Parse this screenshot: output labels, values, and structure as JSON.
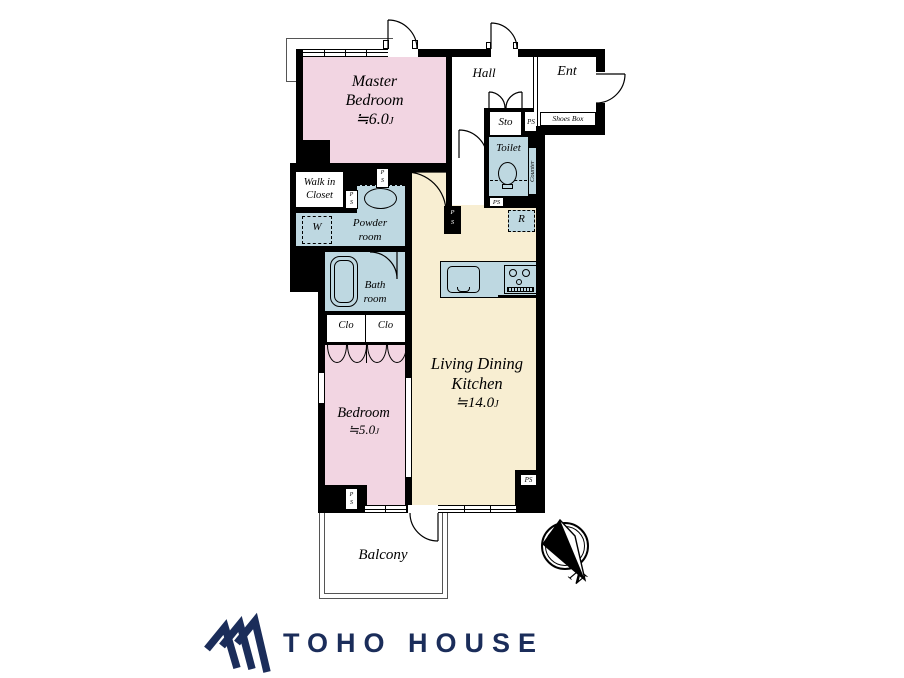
{
  "colors": {
    "wall": "#000000",
    "bedroom_pink": "#f2d5e2",
    "ldk_cream": "#f8eed2",
    "wet_area_blue": "#bed8e1",
    "brand_navy": "#1b2d5a"
  },
  "rooms": {
    "master_bedroom": {
      "line1": "Master",
      "line2": "Bedroom",
      "size": "≒6.0",
      "unit": "J"
    },
    "bedroom": {
      "line1": "Bedroom",
      "size": "≒5.0",
      "unit": "J"
    },
    "ldk": {
      "line1": "Living Dining",
      "line2": "Kitchen",
      "size": "≒14.0",
      "unit": "J"
    },
    "hall": {
      "label": "Hall"
    },
    "ent": {
      "label": "Ent"
    },
    "sto": {
      "label": "Sto"
    },
    "shoes_box": {
      "label": "Shoes Box"
    },
    "toilet": {
      "label": "Toilet"
    },
    "counter": {
      "label": "Counter"
    },
    "counter_small": {
      "label": "Counter"
    },
    "refrigerator": {
      "label": "R"
    },
    "walk_in_closet": {
      "line1": "Walk in",
      "line2": "Closet"
    },
    "powder_room": {
      "line1": "Powder",
      "line2": "room"
    },
    "washer": {
      "label": "W"
    },
    "bath_room": {
      "line1": "Bath",
      "line2": "room"
    },
    "closet": {
      "label": "Clo"
    },
    "balcony": {
      "label": "Balcony"
    }
  },
  "shafts": {
    "ps": "PS",
    "p": "P",
    "s": "S"
  },
  "compass": {
    "north": "N"
  },
  "branding": {
    "logo_text": "TOHO HOUSE"
  }
}
